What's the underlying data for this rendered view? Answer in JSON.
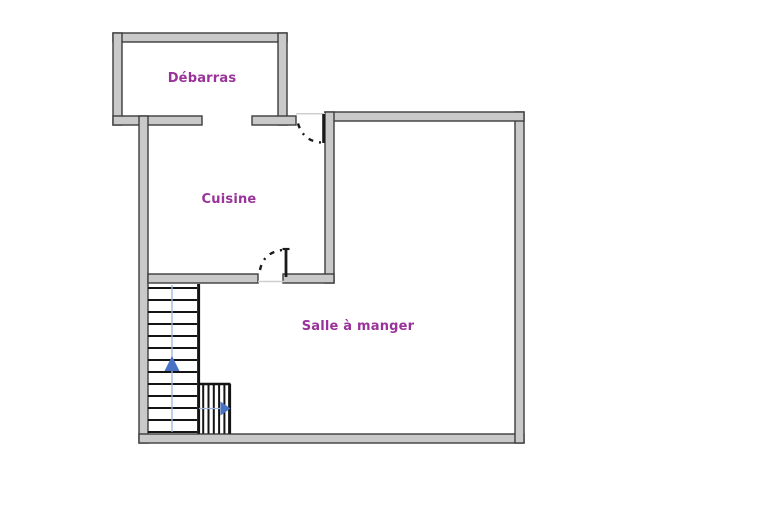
{
  "diagram": {
    "type": "floor-plan",
    "rooms": {
      "debarras": {
        "label": "Débarras"
      },
      "cuisine": {
        "label": "Cuisine"
      },
      "salle_a_manger": {
        "label": "Salle à manger"
      }
    },
    "stairs": {
      "main_flight_direction": "up",
      "lower_flight_direction": "right",
      "tread_count": 13
    },
    "doors": {
      "entrance_door": "between Débarras and Salle à manger top walls, swings into Cuisine",
      "interior_door": "between Cuisine and Salle à manger, swings into Cuisine",
      "open_passage": "between Débarras and Cuisine"
    },
    "colors": {
      "background": "#ffffff",
      "wall_fill": "#c9c9c9",
      "wall_outline": "#3c3c3c",
      "threshold": "#cfcfcf",
      "door_swing": "#1a1a1a",
      "stair_line": "#141414",
      "stair_guide_line": "#9fb4da",
      "stair_arrow": "#4a72c4",
      "room_label": "#993399"
    }
  }
}
